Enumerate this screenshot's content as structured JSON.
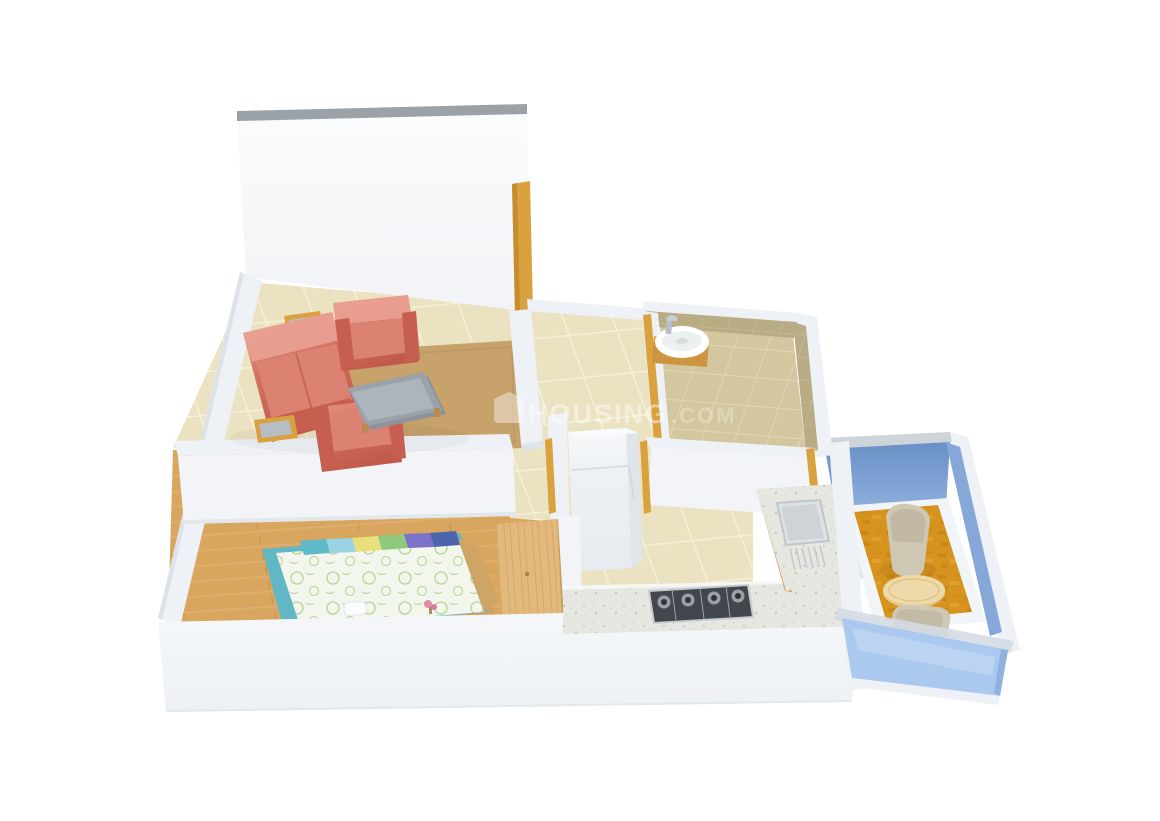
{
  "watermark": {
    "logo": "house-logo-icon",
    "brand": "HOUSING",
    "suffix": ".COM"
  },
  "colors": {
    "background": "#ffffff",
    "wall_face": "#f2f4f7",
    "wall_band": "#eef1f5",
    "wall_side": "#e6eaef",
    "wall_cap_gray": "#9aa1a7",
    "apron": "#f5f7f9",
    "tile_base": "#ebe2c2",
    "tile_grout": "#f6f0d8",
    "wood_base": "#d9a660",
    "bath_floor": "#d3c7a0",
    "bath_wall_tile": "#b7ac83",
    "balcony_wall_blue": "#7195ca",
    "balcony_glass": "#abc8ef",
    "balcony_floor": "#d6941e",
    "door_wood": "#daa13f",
    "sofa_main": "#d4705f",
    "sofa_light": "#e péché"
  },
  "colors_fix": "ignore",
  "palette": {
    "background": "#ffffff",
    "wall_face": "#f2f4f7",
    "wall_band": "#eef1f5",
    "wall_side": "#e6eaef",
    "wall_cap_gray": "#9aa1a7",
    "apron": "#f5f7f9",
    "tile_base": "#ebe2c2",
    "tile_grout": "#f6f0d8",
    "wood_base": "#d9a660",
    "bath_floor": "#d3c7a0",
    "bath_wall_tile": "#b7ac83",
    "balcony_wall_blue": "#7195ca",
    "balcony_glass": "#abc8ef",
    "balcony_floor": "#d6941e",
    "door_wood": "#daa13f",
    "sofa_main": "#d4705f",
    "sofa_light": "#e89a8b",
    "rug": "#c7a26b",
    "coffee_table": "#9ba2a9",
    "side_table_top": "#b7bdc4",
    "bed_quilt": "#f3f6ec",
    "bed_teal": "#62b7c6",
    "bed_frame_tan": "#cfa566",
    "wardrobe_wood": "#e2b87c",
    "counter_granite": "#e7e7e2",
    "hob_dark": "#42474e",
    "steel": "#c6cbd0",
    "fridge": "#f2f4f6",
    "basin_white": "#ffffff",
    "chair_fabric": "#cfc8b5",
    "round_table_wood": "#e5c88f",
    "watermark_white": "#ffffff"
  },
  "bed": {
    "pillow_colors": [
      "#5fb9c9",
      "#9ad4e4",
      "#e9df7d",
      "#8fc97d",
      "#7e72c8",
      "#4e64ad"
    ]
  },
  "scene": {
    "type": "3d-floor-plan-render",
    "rooms": [
      {
        "id": "living-room",
        "floor": "cream-tile",
        "furniture": [
          "three-seater-sofa",
          "armchair",
          "armchair",
          "coffee-table",
          "side-table",
          "side-table",
          "rug"
        ]
      },
      {
        "id": "bedroom",
        "floor": "wood-plank",
        "furniture": [
          "double-bed",
          "wardrobe",
          "slippers",
          "flowers"
        ]
      },
      {
        "id": "kitchen",
        "floor": "cream-tile",
        "furniture": [
          "l-shaped-counter",
          "gas-hob",
          "double-sink",
          "refrigerator"
        ]
      },
      {
        "id": "bathroom",
        "floor": "tan-tile",
        "furniture": [
          "washbasin",
          "wooden-vanity"
        ]
      },
      {
        "id": "balcony",
        "floor": "amber-carpet",
        "furniture": [
          "lounge-chair",
          "lounge-chair",
          "round-table",
          "glass-railing"
        ]
      },
      {
        "id": "hallway",
        "floor": "cream-tile",
        "furniture": []
      }
    ]
  }
}
